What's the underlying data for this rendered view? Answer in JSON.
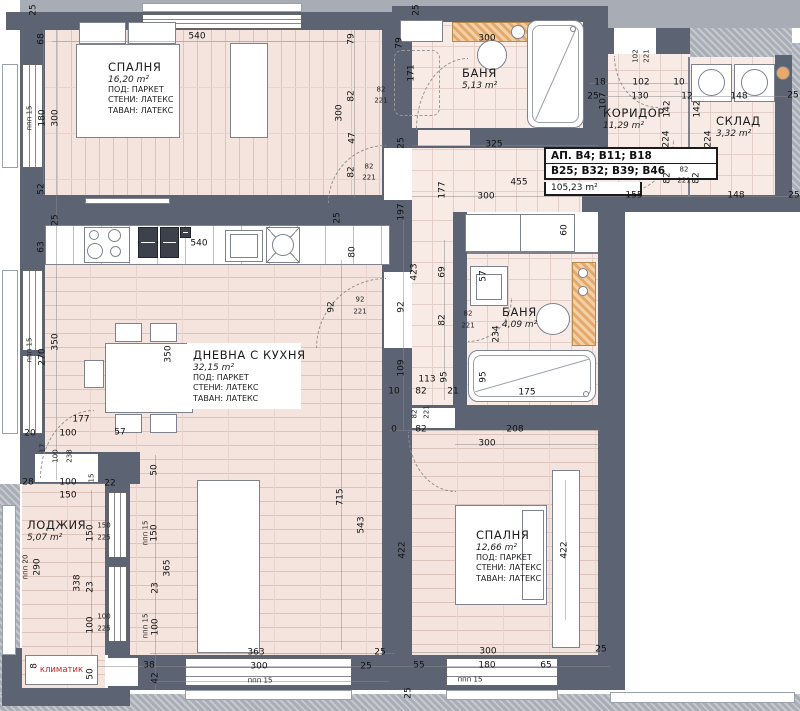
{
  "info_box": {
    "line1": "АП. В4; В11; В18",
    "line2": "В25; В32; В39; В46",
    "area": "105,23 m²"
  },
  "ac_unit": {
    "label": "климатик"
  },
  "rooms": [
    {
      "name": "СПАЛНЯ",
      "area": "16,20 m²",
      "l1": "ПОД: ПАРКЕТ",
      "l2": "СТЕНИ: ЛАТЕКС",
      "l3": "ТАВАН: ЛАТЕКС",
      "x": 108,
      "y": 60,
      "w": 92
    },
    {
      "name": "БАНЯ",
      "area": "5,13 m²",
      "l1": "",
      "l2": "",
      "l3": "",
      "x": 462,
      "y": 66,
      "w": 60
    },
    {
      "name": "КОРИДОР",
      "area": "11,29 m²",
      "l1": "",
      "l2": "",
      "l3": "",
      "x": 603,
      "y": 106,
      "w": 80
    },
    {
      "name": "СКЛАД",
      "area": "3,32 m²",
      "l1": "",
      "l2": "",
      "l3": "",
      "x": 716,
      "y": 114,
      "w": 72
    },
    {
      "name": "ДНЕВНА С КУХНЯ",
      "area": "32,15 m²",
      "l1": "ПОД: ПАРКЕТ",
      "l2": "СТЕНИ: ЛАТЕКС",
      "l3": "ТАВАН: ЛАТЕКС",
      "x": 188,
      "y": 344,
      "w": 112,
      "cls": "bg"
    },
    {
      "name": "БАНЯ",
      "area": "4,09 m²",
      "l1": "",
      "l2": "",
      "l3": "",
      "x": 502,
      "y": 305,
      "w": 60
    },
    {
      "name": "ЛОДЖИЯ",
      "area": "5,07 m²",
      "l1": "",
      "l2": "",
      "l3": "",
      "x": 27,
      "y": 518,
      "w": 70
    },
    {
      "name": "СПАЛНЯ",
      "area": "12,66 m²",
      "l1": "ПОД: ПАРКЕТ",
      "l2": "СТЕНИ: ЛАТЕКС",
      "l3": "ТАВАН: ЛАТЕКС",
      "x": 476,
      "y": 528,
      "w": 92
    }
  ],
  "dims": [
    {
      "t": "25",
      "x": 34,
      "y": 10,
      "v": 1
    },
    {
      "t": "540",
      "x": 197,
      "y": 37
    },
    {
      "t": "68",
      "x": 42,
      "y": 39,
      "v": 1
    },
    {
      "t": "ппп 15",
      "x": 30,
      "y": 118,
      "v": 1,
      "s": 1
    },
    {
      "t": "180",
      "x": 43,
      "y": 118,
      "v": 1
    },
    {
      "t": "300",
      "x": 56,
      "y": 118,
      "v": 1
    },
    {
      "t": "52",
      "x": 42,
      "y": 189,
      "v": 1
    },
    {
      "t": "79",
      "x": 352,
      "y": 39,
      "v": 1
    },
    {
      "t": "82",
      "x": 352,
      "y": 96,
      "v": 1
    },
    {
      "t": "300",
      "x": 340,
      "y": 113,
      "v": 1
    },
    {
      "t": "47",
      "x": 353,
      "y": 138,
      "v": 1
    },
    {
      "t": "82",
      "x": 352,
      "y": 172,
      "v": 1
    },
    {
      "t": "82",
      "x": 369,
      "y": 167,
      "s": 1
    },
    {
      "t": "221",
      "x": 369,
      "y": 178,
      "s": 1
    },
    {
      "t": "25",
      "x": 417,
      "y": 10,
      "v": 1
    },
    {
      "t": "300",
      "x": 487,
      "y": 39
    },
    {
      "t": "79",
      "x": 400,
      "y": 43,
      "v": 1
    },
    {
      "t": "171",
      "x": 412,
      "y": 73,
      "v": 1
    },
    {
      "t": "82",
      "x": 381,
      "y": 90,
      "s": 1
    },
    {
      "t": "221",
      "x": 381,
      "y": 101,
      "s": 1
    },
    {
      "t": "25",
      "x": 593,
      "y": 97
    },
    {
      "t": "18",
      "x": 600,
      "y": 83
    },
    {
      "t": "107",
      "x": 604,
      "y": 101,
      "v": 1
    },
    {
      "t": "102",
      "x": 641,
      "y": 83
    },
    {
      "t": "130",
      "x": 640,
      "y": 97
    },
    {
      "t": "10",
      "x": 679,
      "y": 83
    },
    {
      "t": "12",
      "x": 687,
      "y": 97
    },
    {
      "t": "148",
      "x": 739,
      "y": 97
    },
    {
      "t": "25",
      "x": 793,
      "y": 96
    },
    {
      "t": "102",
      "x": 636,
      "y": 56,
      "v": 1,
      "s": 1
    },
    {
      "t": "221",
      "x": 647,
      "y": 56,
      "v": 1,
      "s": 1
    },
    {
      "t": "142",
      "x": 668,
      "y": 109,
      "v": 1
    },
    {
      "t": "224",
      "x": 667,
      "y": 139,
      "v": 1
    },
    {
      "t": "82",
      "x": 668,
      "y": 178,
      "v": 1
    },
    {
      "t": "142",
      "x": 698,
      "y": 109,
      "v": 1
    },
    {
      "t": "224",
      "x": 709,
      "y": 139,
      "v": 1
    },
    {
      "t": "82",
      "x": 697,
      "y": 178,
      "v": 1
    },
    {
      "t": "82",
      "x": 684,
      "y": 170,
      "s": 1
    },
    {
      "t": "221",
      "x": 684,
      "y": 181,
      "s": 1
    },
    {
      "t": "155",
      "x": 634,
      "y": 196
    },
    {
      "t": "148",
      "x": 736,
      "y": 196
    },
    {
      "t": "25",
      "x": 794,
      "y": 196
    },
    {
      "t": "60",
      "x": 565,
      "y": 230,
      "v": 1
    },
    {
      "t": "325",
      "x": 494,
      "y": 145
    },
    {
      "t": "455",
      "x": 519,
      "y": 183
    },
    {
      "t": "300",
      "x": 486,
      "y": 197
    },
    {
      "t": "177",
      "x": 443,
      "y": 190,
      "v": 1
    },
    {
      "t": "25",
      "x": 402,
      "y": 143,
      "v": 1
    },
    {
      "t": "197",
      "x": 402,
      "y": 212,
      "v": 1
    },
    {
      "t": "423",
      "x": 415,
      "y": 272,
      "v": 1
    },
    {
      "t": "69",
      "x": 443,
      "y": 272,
      "v": 1
    },
    {
      "t": "92",
      "x": 402,
      "y": 307,
      "v": 1
    },
    {
      "t": "82",
      "x": 443,
      "y": 320,
      "v": 1
    },
    {
      "t": "109",
      "x": 402,
      "y": 368,
      "v": 1
    },
    {
      "t": "113",
      "x": 427,
      "y": 380
    },
    {
      "t": "95",
      "x": 445,
      "y": 377,
      "v": 1
    },
    {
      "t": "10",
      "x": 394,
      "y": 392
    },
    {
      "t": "82",
      "x": 421,
      "y": 392
    },
    {
      "t": "21",
      "x": 453,
      "y": 392
    },
    {
      "t": "82",
      "x": 415,
      "y": 414,
      "v": 1,
      "s": 1
    },
    {
      "t": "221",
      "x": 427,
      "y": 412,
      "v": 1,
      "s": 1
    },
    {
      "t": "0",
      "x": 394,
      "y": 430
    },
    {
      "t": "82",
      "x": 421,
      "y": 430
    },
    {
      "t": "80",
      "x": 353,
      "y": 252,
      "v": 1
    },
    {
      "t": "92",
      "x": 332,
      "y": 307,
      "v": 1
    },
    {
      "t": "92",
      "x": 360,
      "y": 300,
      "s": 1
    },
    {
      "t": "221",
      "x": 360,
      "y": 312,
      "s": 1
    },
    {
      "t": "25",
      "x": 338,
      "y": 218,
      "v": 1
    },
    {
      "t": "57",
      "x": 484,
      "y": 276,
      "v": 1
    },
    {
      "t": "82",
      "x": 468,
      "y": 314,
      "s": 1
    },
    {
      "t": "221",
      "x": 468,
      "y": 326,
      "s": 1
    },
    {
      "t": "234",
      "x": 497,
      "y": 334,
      "v": 1
    },
    {
      "t": "95",
      "x": 484,
      "y": 377,
      "v": 1
    },
    {
      "t": "175",
      "x": 527,
      "y": 393
    },
    {
      "t": "208",
      "x": 515,
      "y": 430
    },
    {
      "t": "300",
      "x": 487,
      "y": 444
    },
    {
      "t": "422",
      "x": 403,
      "y": 550,
      "v": 1
    },
    {
      "t": "422",
      "x": 565,
      "y": 550,
      "v": 1
    },
    {
      "t": "300",
      "x": 488,
      "y": 652
    },
    {
      "t": "25",
      "x": 601,
      "y": 650
    },
    {
      "t": "55",
      "x": 419,
      "y": 666
    },
    {
      "t": "180",
      "x": 487,
      "y": 666
    },
    {
      "t": "65",
      "x": 546,
      "y": 666
    },
    {
      "t": "ппп 15",
      "x": 470,
      "y": 680,
      "s": 1
    },
    {
      "t": "25",
      "x": 409,
      "y": 693,
      "v": 1
    },
    {
      "t": "25",
      "x": 380,
      "y": 653
    },
    {
      "t": "25",
      "x": 366,
      "y": 667
    },
    {
      "t": "63",
      "x": 42,
      "y": 247,
      "v": 1
    },
    {
      "t": "25",
      "x": 56,
      "y": 220,
      "v": 1
    },
    {
      "t": "540",
      "x": 199,
      "y": 244
    },
    {
      "t": "ппп 15",
      "x": 30,
      "y": 350,
      "v": 1,
      "s": 1
    },
    {
      "t": "270",
      "x": 43,
      "y": 357,
      "v": 1
    },
    {
      "t": "350",
      "x": 56,
      "y": 342,
      "v": 1
    },
    {
      "t": "350",
      "x": 169,
      "y": 354,
      "v": 1
    },
    {
      "t": "177",
      "x": 81,
      "y": 420
    },
    {
      "t": "20",
      "x": 30,
      "y": 434
    },
    {
      "t": "100",
      "x": 68,
      "y": 434
    },
    {
      "t": "57",
      "x": 120,
      "y": 433
    },
    {
      "t": "17",
      "x": 43,
      "y": 448,
      "v": 1,
      "s": 1
    },
    {
      "t": "100",
      "x": 56,
      "y": 456,
      "v": 1,
      "s": 1
    },
    {
      "t": "238",
      "x": 70,
      "y": 456,
      "v": 1,
      "s": 1
    },
    {
      "t": "363",
      "x": 256,
      "y": 653
    },
    {
      "t": "300",
      "x": 259,
      "y": 667
    },
    {
      "t": "ппп 15",
      "x": 260,
      "y": 681,
      "s": 1
    },
    {
      "t": "715",
      "x": 341,
      "y": 497,
      "v": 1
    },
    {
      "t": "543",
      "x": 362,
      "y": 525,
      "v": 1
    },
    {
      "t": "28",
      "x": 28,
      "y": 483
    },
    {
      "t": "100",
      "x": 68,
      "y": 483
    },
    {
      "t": "15",
      "x": 92,
      "y": 478,
      "v": 1,
      "s": 1
    },
    {
      "t": "22",
      "x": 110,
      "y": 484
    },
    {
      "t": "150",
      "x": 68,
      "y": 496
    },
    {
      "t": "150",
      "x": 91,
      "y": 533,
      "v": 1
    },
    {
      "t": "150",
      "x": 104,
      "y": 526,
      "s": 1
    },
    {
      "t": "225",
      "x": 104,
      "y": 538,
      "s": 1
    },
    {
      "t": "290",
      "x": 38,
      "y": 567,
      "v": 1
    },
    {
      "t": "ппп 20",
      "x": 26,
      "y": 567,
      "v": 1,
      "s": 1
    },
    {
      "t": "338",
      "x": 78,
      "y": 583,
      "v": 1
    },
    {
      "t": "23",
      "x": 91,
      "y": 587,
      "v": 1
    },
    {
      "t": "100",
      "x": 91,
      "y": 625,
      "v": 1
    },
    {
      "t": "100",
      "x": 104,
      "y": 617,
      "s": 1
    },
    {
      "t": "225",
      "x": 104,
      "y": 629,
      "s": 1
    },
    {
      "t": "50",
      "x": 91,
      "y": 674,
      "v": 1
    },
    {
      "t": "8",
      "x": 35,
      "y": 666,
      "v": 1
    },
    {
      "t": "50",
      "x": 155,
      "y": 470,
      "v": 1
    },
    {
      "t": "ппп 15",
      "x": 146,
      "y": 533,
      "v": 1,
      "s": 1
    },
    {
      "t": "150",
      "x": 155,
      "y": 533,
      "v": 1
    },
    {
      "t": "365",
      "x": 168,
      "y": 568,
      "v": 1
    },
    {
      "t": "23",
      "x": 156,
      "y": 588,
      "v": 1
    },
    {
      "t": "ппп 15",
      "x": 146,
      "y": 626,
      "v": 1,
      "s": 1
    },
    {
      "t": "100",
      "x": 156,
      "y": 627,
      "v": 1
    },
    {
      "t": "38",
      "x": 149,
      "y": 666
    },
    {
      "t": "42",
      "x": 156,
      "y": 678,
      "v": 1
    }
  ]
}
